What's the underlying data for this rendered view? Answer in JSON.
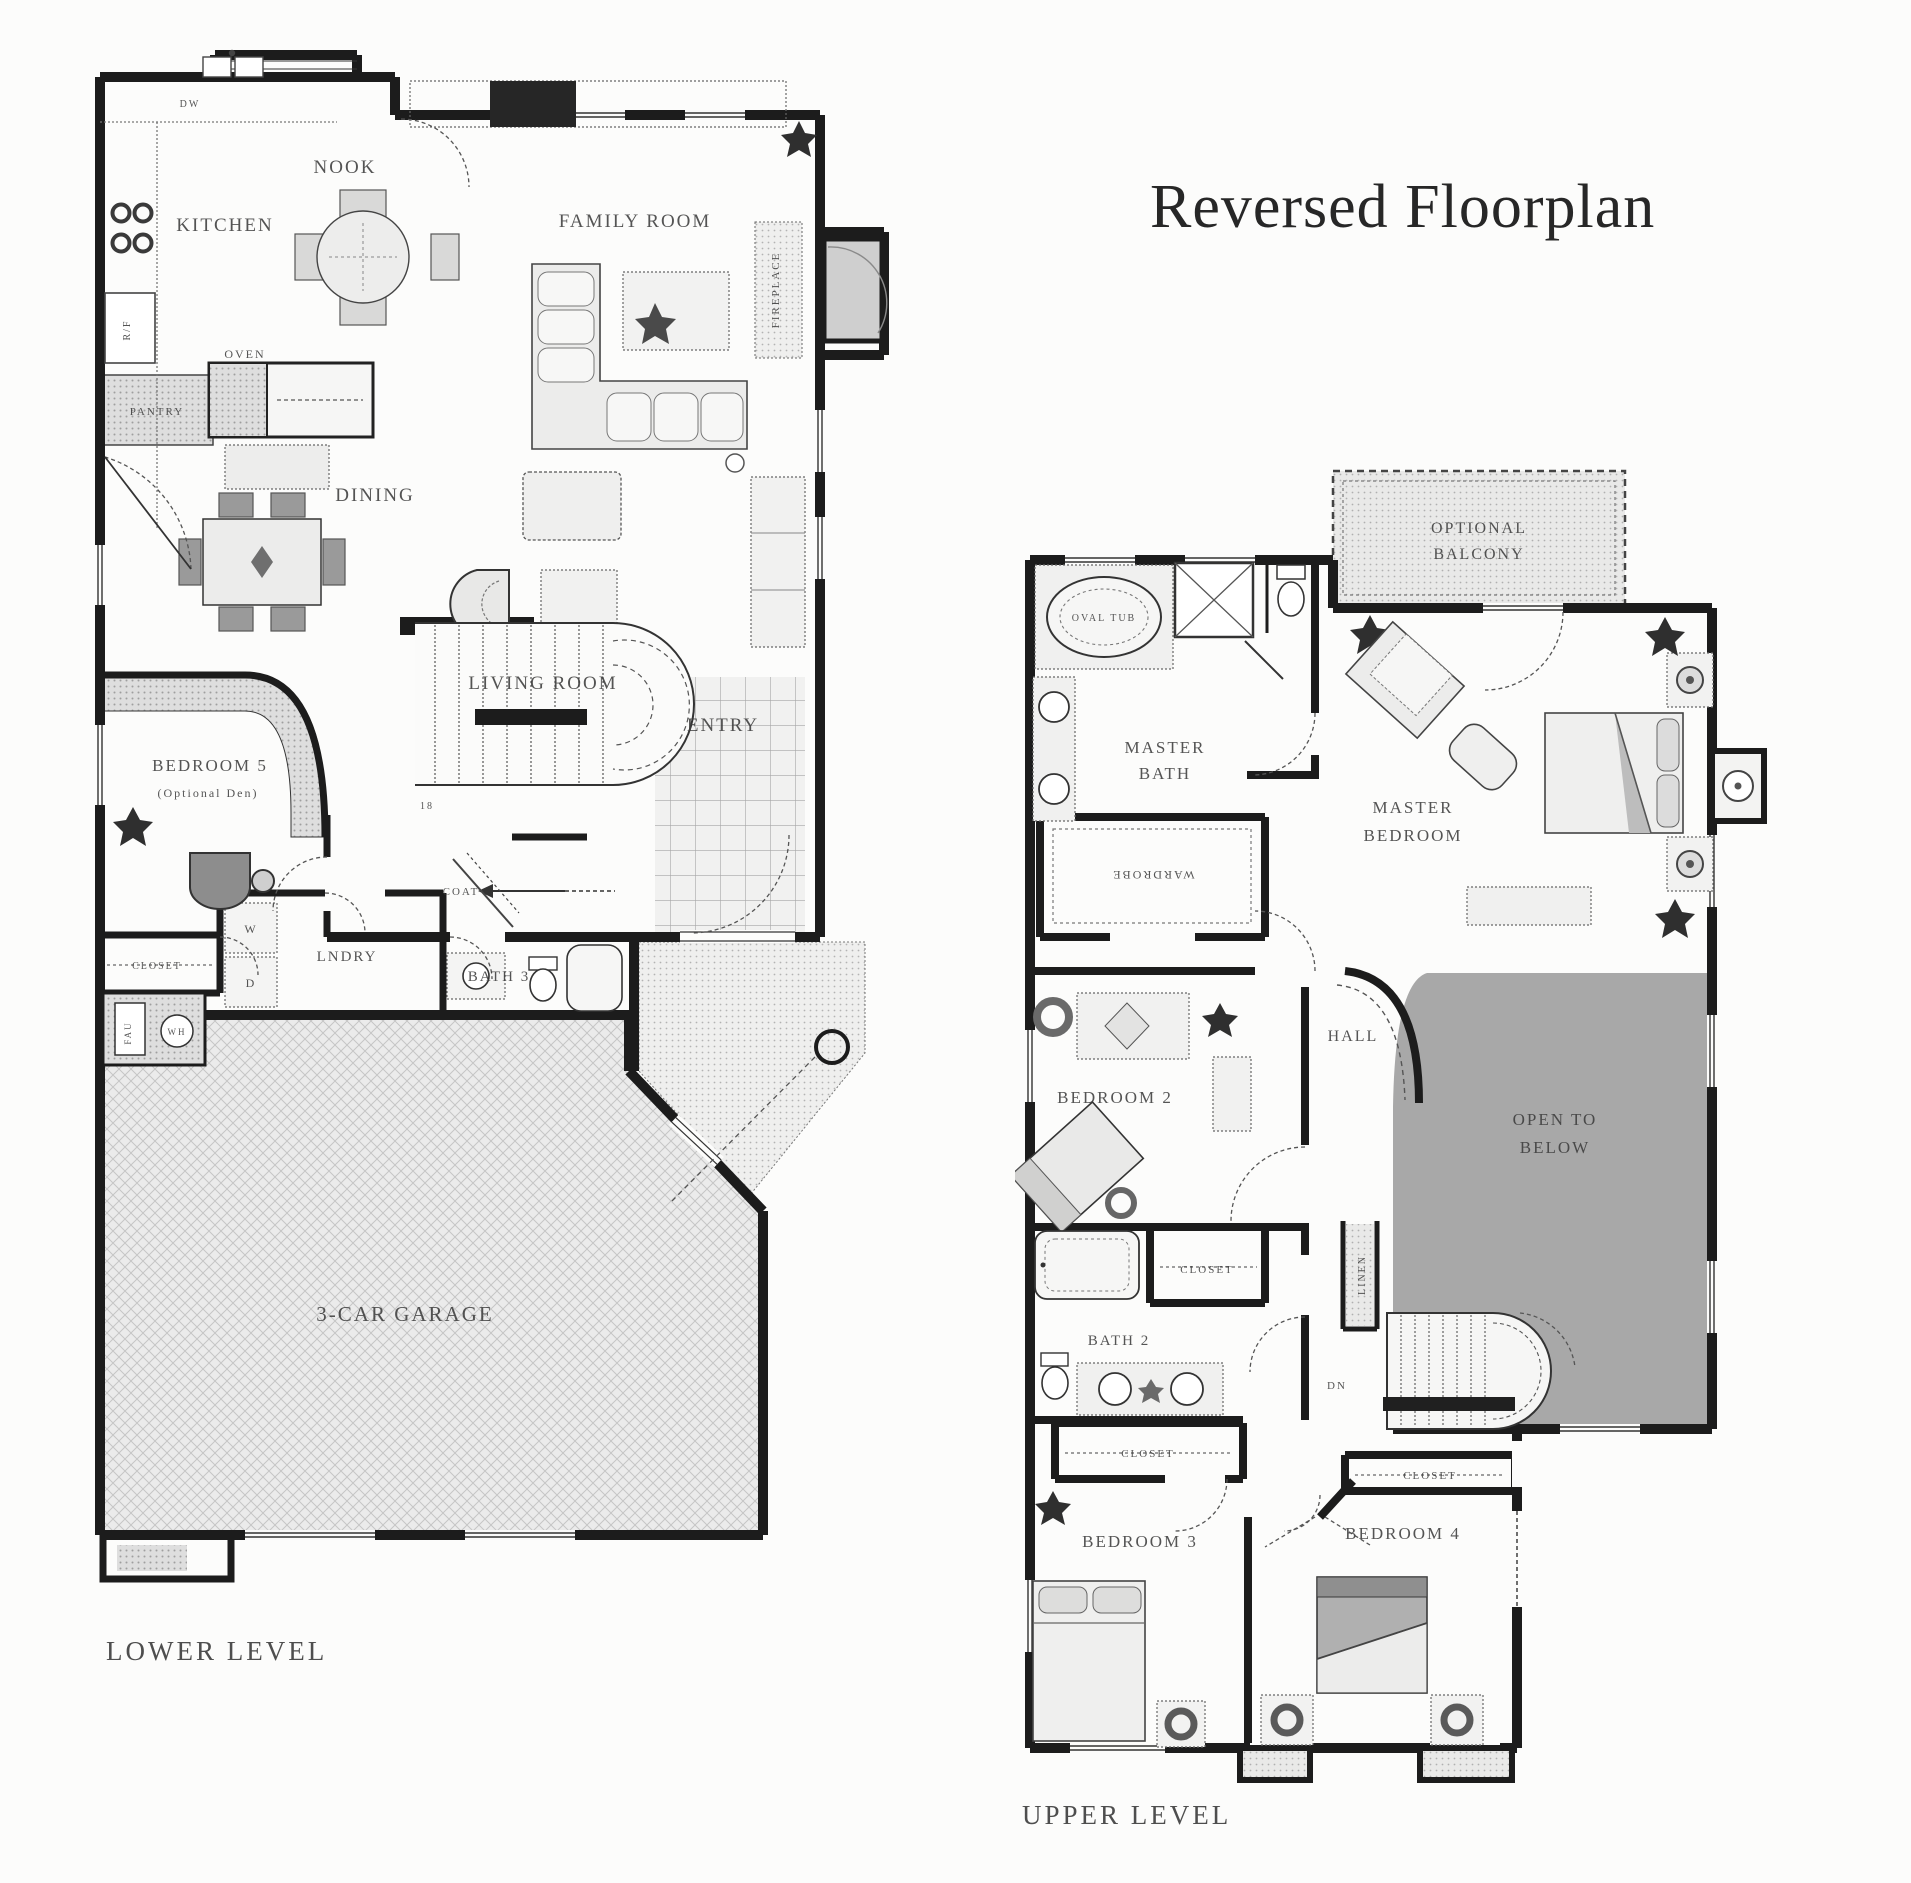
{
  "palette": {
    "wall": "#1c1c1c",
    "open_to_below_shade": "#a8a8a8",
    "texture_gray": "#dedede",
    "garage_hatch": "#ebebeb",
    "label_text": "#3d3d3d"
  },
  "title": "Reversed Floorplan",
  "lower": {
    "caption": "LOWER LEVEL",
    "kitchen": "KITCHEN",
    "nook": "NOOK",
    "family_room": "FAMILY ROOM",
    "dining": "DINING",
    "living_room": "LIVING ROOM",
    "entry": "ENTRY",
    "bedroom5": "BEDROOM 5",
    "bedroom5_note": "(Optional Den)",
    "laundry": "LNDRY",
    "bath3": "BATH 3",
    "garage": "3-CAR GARAGE",
    "closet": "CLOSET",
    "coat": "COAT",
    "pantry": "PANTRY",
    "oven": "OVEN",
    "refrigerator": "R/F",
    "dishwasher": "DW",
    "fireplace": "FIREPLACE",
    "washer": "W",
    "dryer": "D",
    "fau": "FAU",
    "water_heater": "WH",
    "stair_risers": "18"
  },
  "upper": {
    "caption": "UPPER LEVEL",
    "balcony1": "OPTIONAL",
    "balcony2": "BALCONY",
    "master_bath1": "MASTER",
    "master_bath2": "BATH",
    "master_bedroom1": "MASTER",
    "master_bedroom2": "BEDROOM",
    "oval_tub": "OVAL TUB",
    "wardrobe": "WARDROBE",
    "bedroom2": "BEDROOM 2",
    "hall": "HALL",
    "open1": "OPEN TO",
    "open2": "BELOW",
    "linen": "LINEN",
    "closet_bedroom2": "CLOSET",
    "bath2": "BATH 2",
    "closet_hall": "CLOSET",
    "closet_bedroom4": "CLOSET",
    "down": "DN",
    "bedroom3": "BEDROOM 3",
    "bedroom4": "BEDROOM 4"
  }
}
